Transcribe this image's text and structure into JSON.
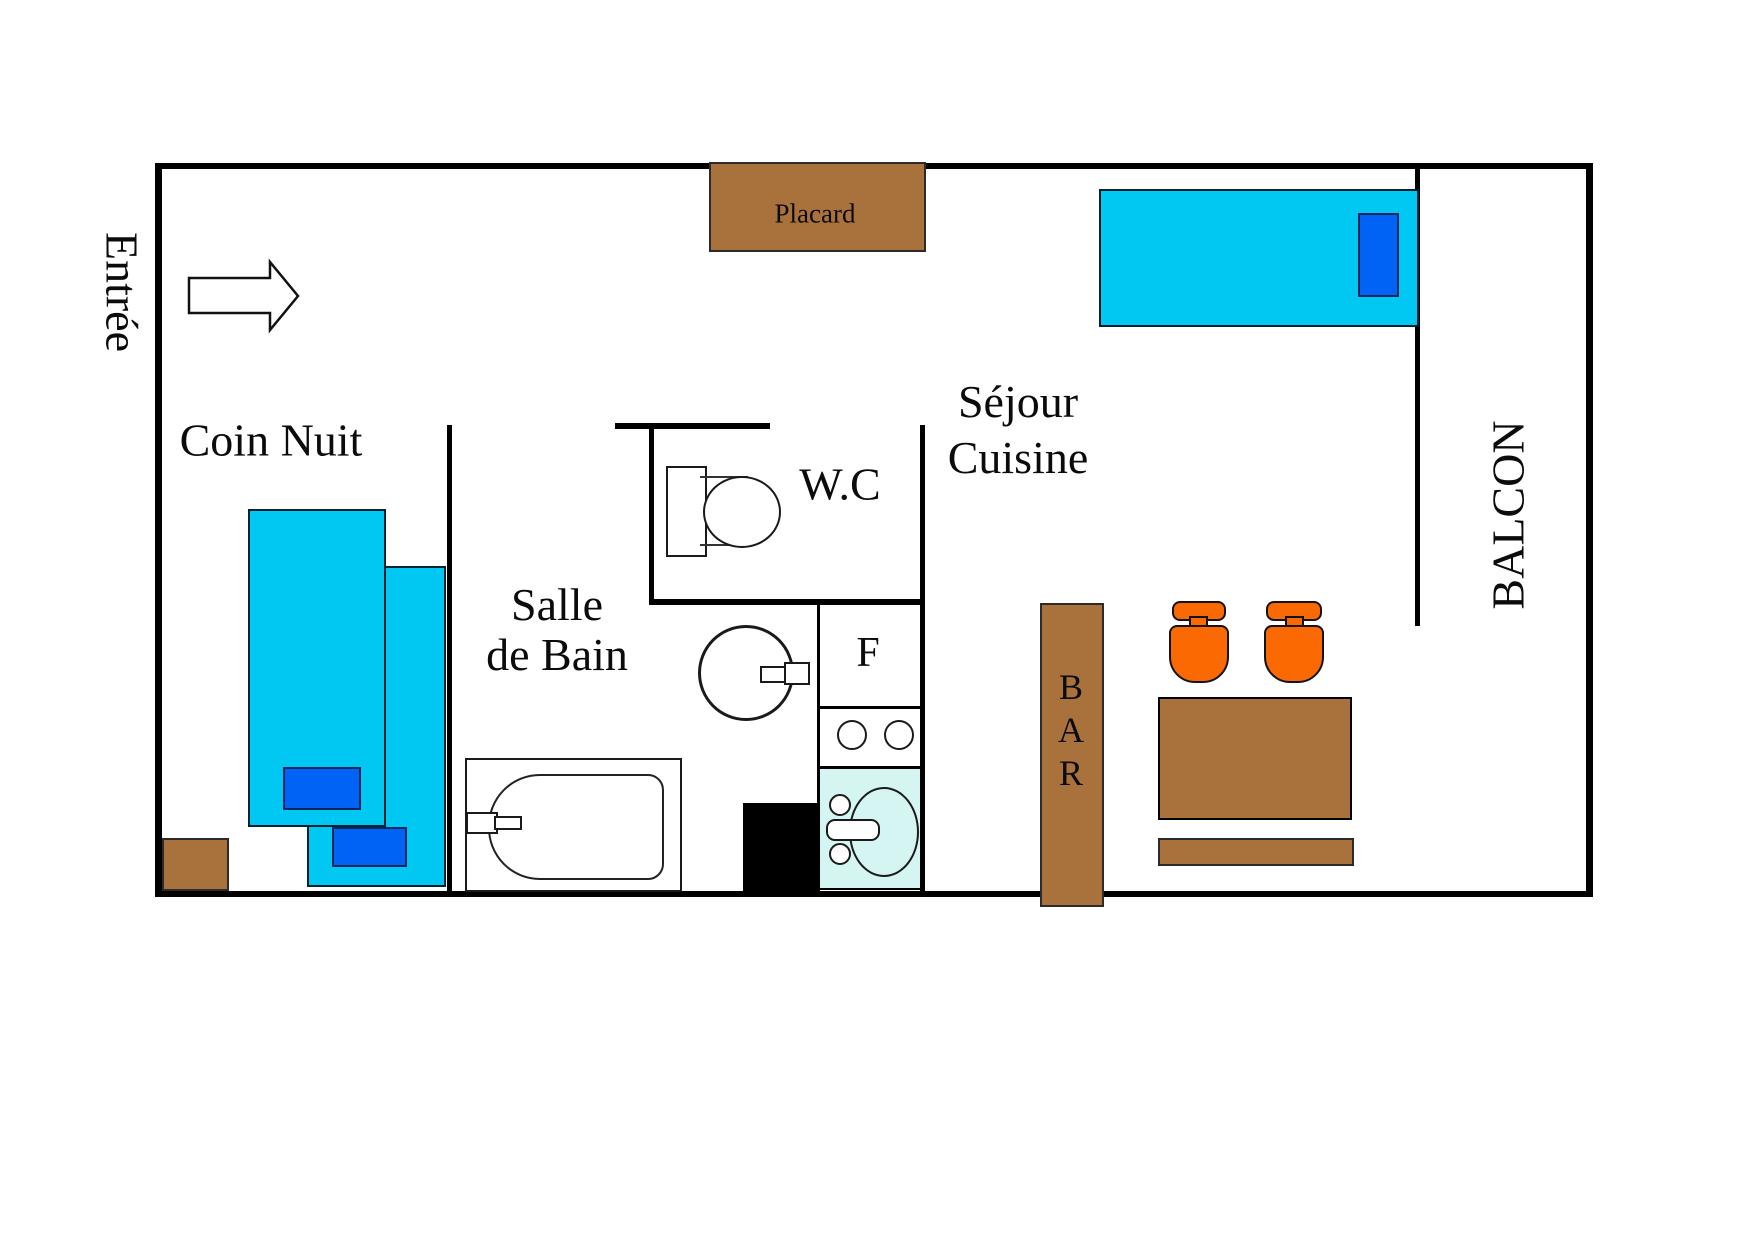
{
  "labels": {
    "entree": "Entrée",
    "coin_nuit": "Coin Nuit",
    "salle_de_bain_line1": "Salle",
    "salle_de_bain_line2": "de Bain",
    "wc": "W.C",
    "sejour_line1": "Séjour",
    "sejour_line2": "Cuisine",
    "balcon": "BALCON",
    "placard": "Placard",
    "bar": "BAR",
    "fridge": "F"
  },
  "colors": {
    "wall": "#000000",
    "bed": "#00c8f2",
    "pillow": "#0063f5",
    "wood": "#a9713c",
    "chair": "#fb6a02",
    "kitchen_sink_area": "#d5f5f2",
    "shower_block": "#000000",
    "background": "#ffffff"
  }
}
